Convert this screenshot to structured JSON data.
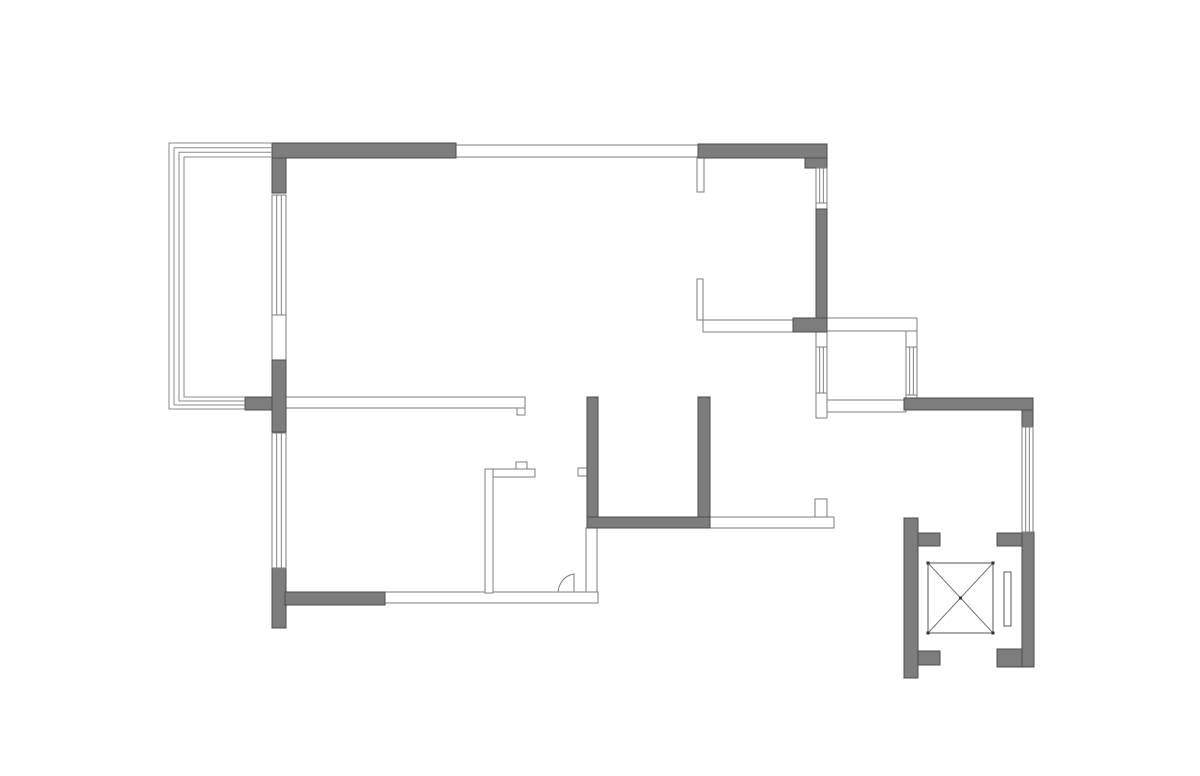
{
  "meta": {
    "title": "Apartment floor plan line drawing",
    "type": "floor-plan"
  },
  "canvas": {
    "width": 1200,
    "height": 776,
    "background": "#ffffff"
  },
  "style": {
    "wall_fill": "#7d7d7d",
    "wall_stroke": "#4d4d4d",
    "outline_fill": "#ffffff",
    "outline_stroke": "#7e7e7e",
    "rail_stroke": "#8a8a8a",
    "window_stroke": "#7e7e7e",
    "elevator_stroke": "#555555",
    "diagonal_stroke": "#777777",
    "dot_fill": "#333333",
    "line_width": 1
  },
  "solid_walls": [
    {
      "name": "top-wall-left",
      "x": 272,
      "y": 143,
      "w": 184,
      "h": 15
    },
    {
      "name": "left-corner-block",
      "x": 272,
      "y": 158,
      "w": 14,
      "h": 35
    },
    {
      "name": "top-wall-right",
      "x": 698,
      "y": 144,
      "w": 129,
      "h": 14
    },
    {
      "name": "top-right-corner-block",
      "x": 805,
      "y": 158,
      "w": 22,
      "h": 10
    },
    {
      "name": "right-wall-upper",
      "x": 816,
      "y": 209,
      "w": 11,
      "h": 123
    },
    {
      "name": "right-wall-step",
      "x": 793,
      "y": 318,
      "w": 34,
      "h": 14
    },
    {
      "name": "left-wall-middle",
      "x": 272,
      "y": 360,
      "w": 14,
      "h": 72
    },
    {
      "name": "balcony-junction-stub",
      "x": 245,
      "y": 397,
      "w": 27,
      "h": 13
    },
    {
      "name": "left-wall-lower",
      "x": 272,
      "y": 568,
      "w": 14,
      "h": 60
    },
    {
      "name": "bottom-wall-gray",
      "x": 285,
      "y": 592,
      "w": 100,
      "h": 13
    },
    {
      "name": "bathroom-wall-left",
      "x": 587,
      "y": 397,
      "w": 11,
      "h": 131
    },
    {
      "name": "bathroom-wall-right",
      "x": 698,
      "y": 397,
      "w": 12,
      "h": 121
    },
    {
      "name": "bathroom-wall-bottom",
      "x": 587,
      "y": 517,
      "w": 123,
      "h": 11
    },
    {
      "name": "lobby-top-wall",
      "x": 904,
      "y": 398,
      "w": 129,
      "h": 12
    },
    {
      "name": "lobby-right-wall-upper",
      "x": 1022,
      "y": 410,
      "w": 11,
      "h": 17
    },
    {
      "name": "lobby-right-wall-lower",
      "x": 1022,
      "y": 532,
      "w": 12,
      "h": 135
    },
    {
      "name": "lobby-tab-top-right",
      "x": 997,
      "y": 533,
      "w": 25,
      "h": 13
    },
    {
      "name": "lobby-tab-bottom-right",
      "x": 997,
      "y": 649,
      "w": 25,
      "h": 18
    },
    {
      "name": "lobby-left-wall",
      "x": 904,
      "y": 518,
      "w": 14,
      "h": 160
    },
    {
      "name": "lobby-tab-top-left",
      "x": 918,
      "y": 533,
      "w": 22,
      "h": 13
    },
    {
      "name": "lobby-tab-bottom-left",
      "x": 918,
      "y": 651,
      "w": 22,
      "h": 14
    }
  ],
  "outline_walls": [
    {
      "name": "top-wall-middle",
      "x": 456,
      "y": 145,
      "w": 242,
      "h": 12
    },
    {
      "name": "top-wall-stub",
      "x": 697,
      "y": 157,
      "w": 7,
      "h": 35
    },
    {
      "name": "balcony-door-opening",
      "x": 272,
      "y": 315,
      "w": 14,
      "h": 45
    },
    {
      "name": "right-wall-gap",
      "x": 816,
      "y": 203,
      "w": 11,
      "h": 6
    },
    {
      "name": "interior-wall-horizontal",
      "x": 286,
      "y": 397,
      "w": 239,
      "h": 11
    },
    {
      "name": "interior-wall-end-hook",
      "x": 517,
      "y": 408,
      "w": 8,
      "h": 7
    },
    {
      "name": "interior-stub-vertical",
      "x": 697,
      "y": 279,
      "w": 6,
      "h": 41
    },
    {
      "name": "interior-stub-horizontal",
      "x": 703,
      "y": 320,
      "w": 90,
      "h": 12
    },
    {
      "name": "alcove-top-wall",
      "x": 827,
      "y": 318,
      "w": 90,
      "h": 13
    },
    {
      "name": "alcove-right-wall",
      "x": 906,
      "y": 331,
      "w": 11,
      "h": 69
    },
    {
      "name": "alcove-bottom-wall",
      "x": 827,
      "y": 400,
      "w": 79,
      "h": 12
    },
    {
      "name": "right-wall-below-alcove",
      "x": 816,
      "y": 332,
      "w": 11,
      "h": 86
    },
    {
      "name": "entry-door-stub",
      "x": 815,
      "y": 499,
      "w": 12,
      "h": 18
    },
    {
      "name": "entry-wall-horizontal",
      "x": 710,
      "y": 517,
      "w": 124,
      "h": 11
    },
    {
      "name": "bathroom-wall-left-lower",
      "x": 586,
      "y": 528,
      "w": 11,
      "h": 65
    },
    {
      "name": "bottom-wall-thin",
      "x": 385,
      "y": 592,
      "w": 213,
      "h": 11
    },
    {
      "name": "counter-vertical",
      "x": 485,
      "y": 469,
      "w": 8,
      "h": 124
    },
    {
      "name": "counter-horizontal",
      "x": 493,
      "y": 469,
      "w": 42,
      "h": 8
    },
    {
      "name": "counter-tab",
      "x": 516,
      "y": 462,
      "w": 11,
      "h": 7
    },
    {
      "name": "bathroom-wall-tab",
      "x": 578,
      "y": 468,
      "w": 9,
      "h": 8
    }
  ],
  "windows": [
    {
      "name": "balcony-window-upper",
      "x": 272,
      "y": 195,
      "w": 14,
      "h": 120
    },
    {
      "name": "balcony-window-lower",
      "x": 272,
      "y": 433,
      "w": 14,
      "h": 135
    },
    {
      "name": "right-window-upper",
      "x": 816,
      "y": 168,
      "w": 11,
      "h": 35
    },
    {
      "name": "right-window-lower",
      "x": 816,
      "y": 347,
      "w": 11,
      "h": 46
    },
    {
      "name": "alcove-window-right",
      "x": 906,
      "y": 347,
      "w": 11,
      "h": 48
    },
    {
      "name": "lobby-window-right",
      "x": 1022,
      "y": 427,
      "w": 11,
      "h": 105
    }
  ],
  "balcony_rails": [
    {
      "points": [
        [
          272,
          143
        ],
        [
          169,
          143
        ],
        [
          169,
          409
        ],
        [
          245,
          409
        ]
      ]
    },
    {
      "points": [
        [
          272,
          147.7
        ],
        [
          174,
          147.7
        ],
        [
          174,
          405
        ],
        [
          245,
          405
        ]
      ]
    },
    {
      "points": [
        [
          272,
          152.3
        ],
        [
          179,
          152.3
        ],
        [
          179,
          401
        ],
        [
          245,
          401
        ]
      ]
    },
    {
      "points": [
        [
          272,
          157
        ],
        [
          184,
          157
        ],
        [
          184,
          397
        ],
        [
          245,
          397
        ]
      ]
    }
  ],
  "elevator": {
    "car": {
      "x": 928,
      "y": 563,
      "w": 65,
      "h": 70
    },
    "door": {
      "x": 1004,
      "y": 572,
      "w": 7,
      "h": 54
    },
    "dot_size": 3
  },
  "door_swing": {
    "path": "M 558 592 C 559 584 563 578 570 575 L 574 574 L 574 592"
  }
}
